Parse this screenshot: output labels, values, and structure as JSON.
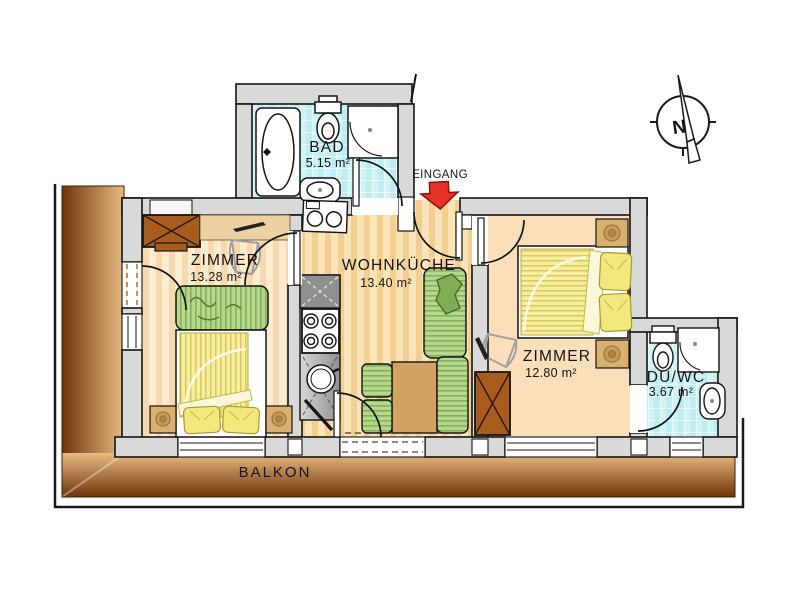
{
  "plan": {
    "compass": {
      "north_label": "N"
    },
    "entrance": {
      "label": "EINGANG"
    },
    "balcony": {
      "label": "BALKON"
    },
    "rooms": {
      "bad": {
        "name": "BAD",
        "area": "5.15 m²"
      },
      "zimmer_left": {
        "name": "ZIMMER",
        "area": "13.28 m²"
      },
      "wohnkueche": {
        "name": "WOHNKÜCHE",
        "area": "13.40 m²"
      },
      "zimmer_right": {
        "name": "ZIMMER",
        "area": "12.80 m²"
      },
      "du_wc": {
        "name": "DU/WC",
        "area": "3.67 m²"
      }
    },
    "colors": {
      "arrow_red": "#e63228",
      "tile_cyan": "#bdedf1",
      "floor_tan": "#fbe3ba",
      "balcony_dark": "#6f3409",
      "balcony_light": "#e8bc82",
      "furniture_green": "#b4d88c",
      "furniture_yellow": "#f6ef9f",
      "wood_brown": "#a85c1e",
      "wall_gray": "#d9d9d9"
    }
  }
}
